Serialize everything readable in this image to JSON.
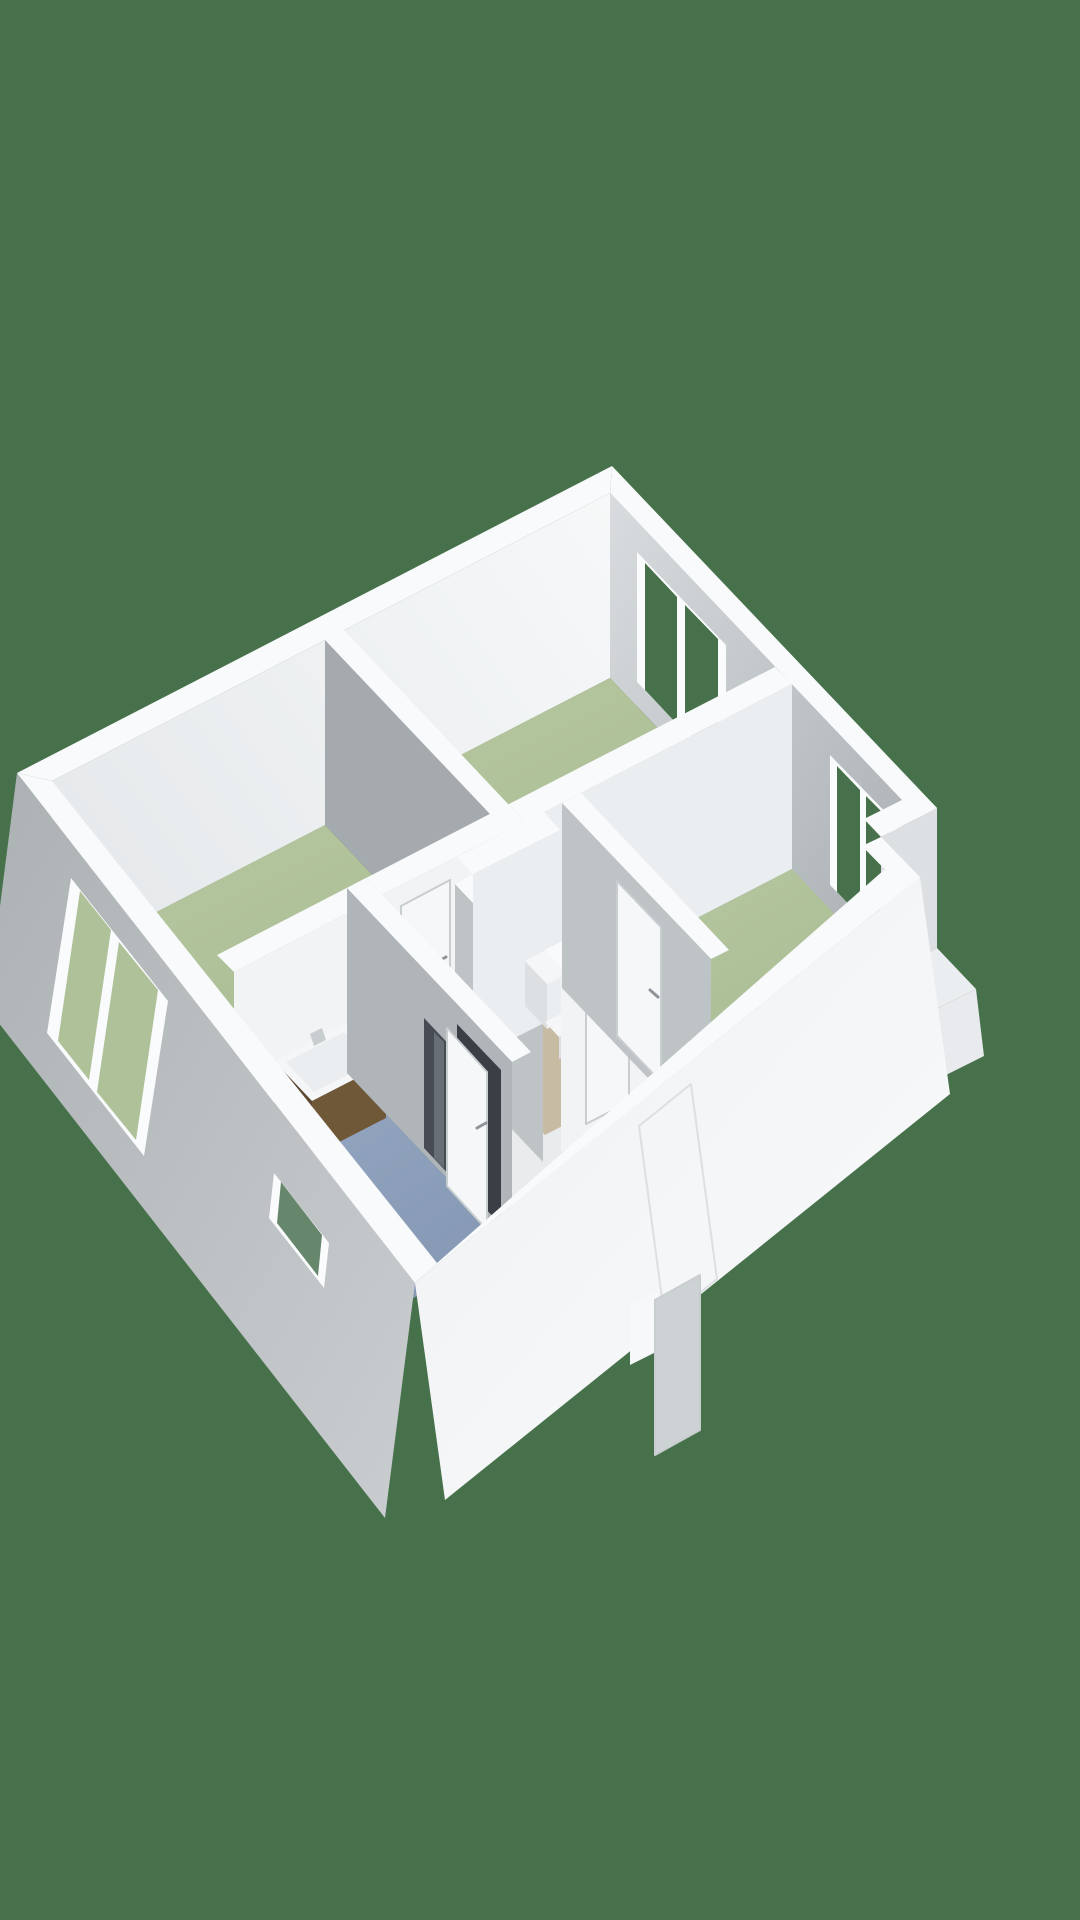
{
  "meta": {
    "kind": "3d-floorplan-render",
    "width": 1080,
    "height": 1920
  },
  "colors": {
    "bg": "#47714A",
    "band": "#F8FAFB",
    "tlA": "#F6F8F9",
    "tlB": "#E7EAEC",
    "trA": "#D8DCDF",
    "trB": "#A8AEB2",
    "faA": "#ACB1B4",
    "faB": "#C9CDD0",
    "frA": "#EFF1F3",
    "frB": "#F8FAFB",
    "flA": "#B8C9A2",
    "flB": "#A6B990",
    "blA": "#97A9C3",
    "blB": "#8497B3",
    "wallLit": "#F1F3F4",
    "wallLit2": "#EBEEF0",
    "shadeLight": "#DDE0E2",
    "shadeMed": "#BEC3C6",
    "shadeMed2": "#AFB5B9",
    "shadeDark": "#A4AAAE",
    "hallFloor": "#E9EBEC",
    "floorBeige": "#C8BBA3",
    "glassBg": "#47714A",
    "glassRoom": "#AFC199",
    "slitGlass": "#67876C",
    "frameWhite": "#FAFBFC",
    "cabinetFront": "#6F5838",
    "cabinetSide": "#5C4830",
    "fixtureWhite": "#F4F6F7",
    "showerGlass": "#41464D",
    "showerStreak": "#7A8189",
    "shaftDark": "#4E5357",
    "shaftLight": "#797F84",
    "doorPanel": "#F5F7F8",
    "doorEdge": "#C8CDD0",
    "handle": "#8E9499",
    "openDoor": "#CDD2D5",
    "darkGap": "#3A3F45",
    "stepWhite": "#F6F8F9",
    "platformFront": "#E8EAED"
  },
  "scene": {
    "background": "solid-green",
    "rooms": [
      {
        "name": "living-room",
        "floor": "green"
      },
      {
        "name": "bedroom-left",
        "floor": "green"
      },
      {
        "name": "bedroom-right",
        "floor": "green"
      },
      {
        "name": "hallway",
        "floor": "white"
      },
      {
        "name": "bathroom",
        "floor": "blue"
      },
      {
        "name": "toilet-room",
        "floor": "beige"
      }
    ],
    "fixtures": [
      "washbasin-vanity",
      "shower-glass",
      "toilet"
    ],
    "openings": {
      "exterior-windows": 4,
      "interior-doors": 4,
      "front-door-open": 1,
      "shaft": 1
    }
  }
}
